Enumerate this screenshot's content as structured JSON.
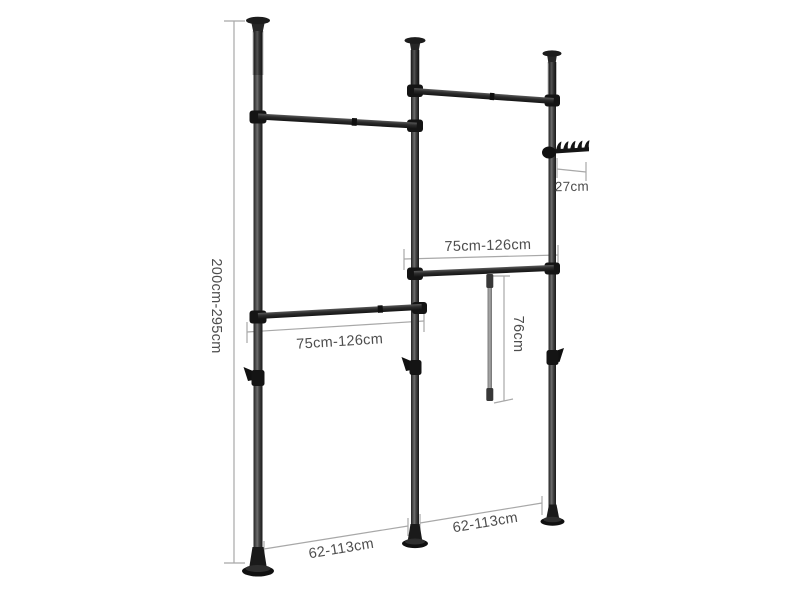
{
  "diagram": {
    "kind": "product-dimension-diagram",
    "dimensions": {
      "height": {
        "label": "200cm-295cm",
        "orientation": "vertical"
      },
      "left_bar": {
        "label": "75cm-126cm",
        "orientation": "horizontal"
      },
      "right_bar": {
        "label": "75cm-126cm",
        "orientation": "horizontal"
      },
      "drop_rod": {
        "label": "76cm",
        "orientation": "vertical"
      },
      "hook_rack": {
        "label": "27cm",
        "orientation": "horizontal"
      },
      "left_floor_span": {
        "label": "62-113cm",
        "orientation": "horizontal"
      },
      "right_floor_span": {
        "label": "62-113cm",
        "orientation": "horizontal"
      }
    },
    "colors": {
      "background": "#ffffff",
      "frame_dark": "#1c1c1c",
      "frame_mid": "#6e6e6e",
      "dimension_line": "#a8a8a8",
      "label_text": "#4d4d4d"
    }
  }
}
